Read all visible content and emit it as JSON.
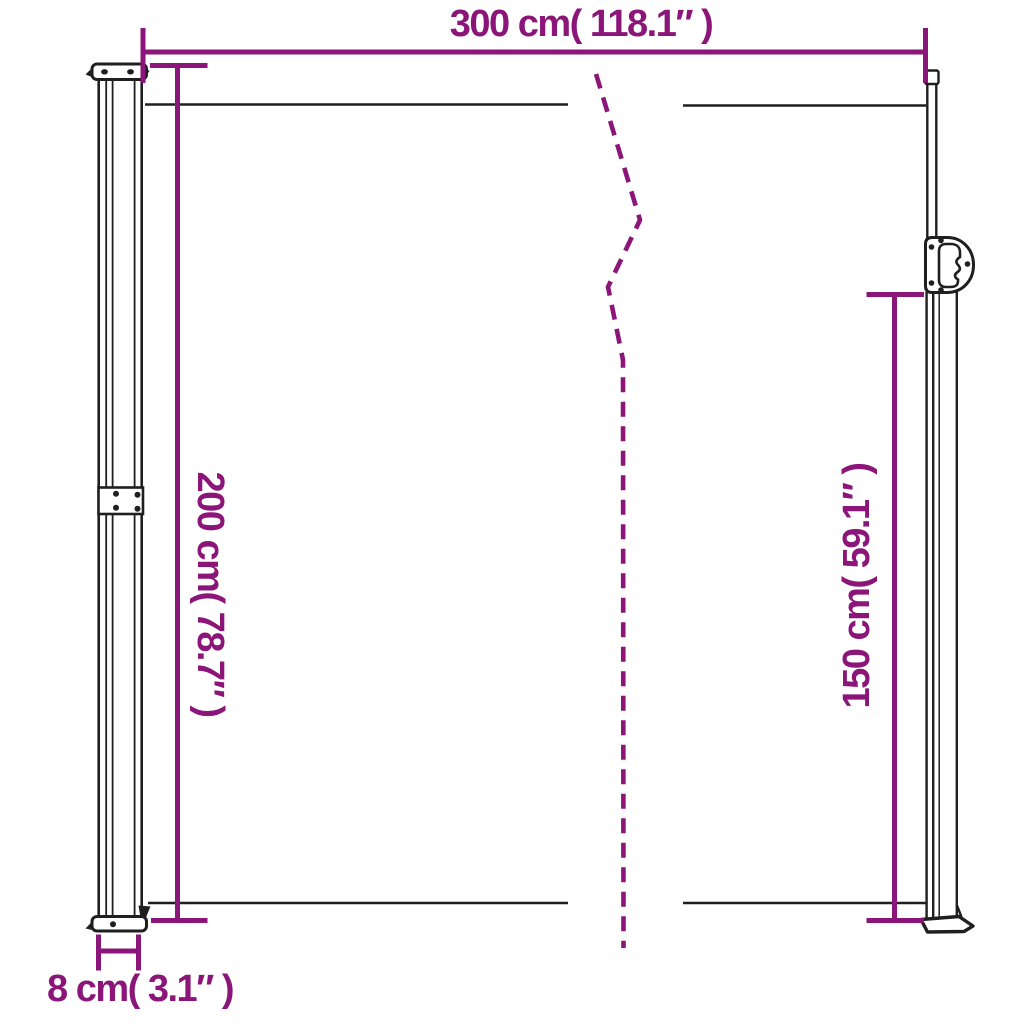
{
  "diagram": {
    "title": "Retractable side awning dimension drawing",
    "dimensions": {
      "width": {
        "value": "300",
        "unit": "cm",
        "inches": "118.1",
        "label": "300 cm( 118.1″ )"
      },
      "height_left": {
        "value": "200",
        "unit": "cm",
        "inches": "78.7",
        "label": "200 cm( 78.7″ )"
      },
      "height_right": {
        "value": "150",
        "unit": "cm",
        "inches": "59.1",
        "label": "150 cm( 59.1″ )"
      },
      "depth": {
        "value": "8",
        "unit": "cm",
        "inches": "3.1",
        "label": "8 cm( 3.1″ )"
      }
    },
    "colors": {
      "dimension": "#8b1578",
      "ink": "#1f1f1f",
      "bg": "#ffffff"
    }
  }
}
